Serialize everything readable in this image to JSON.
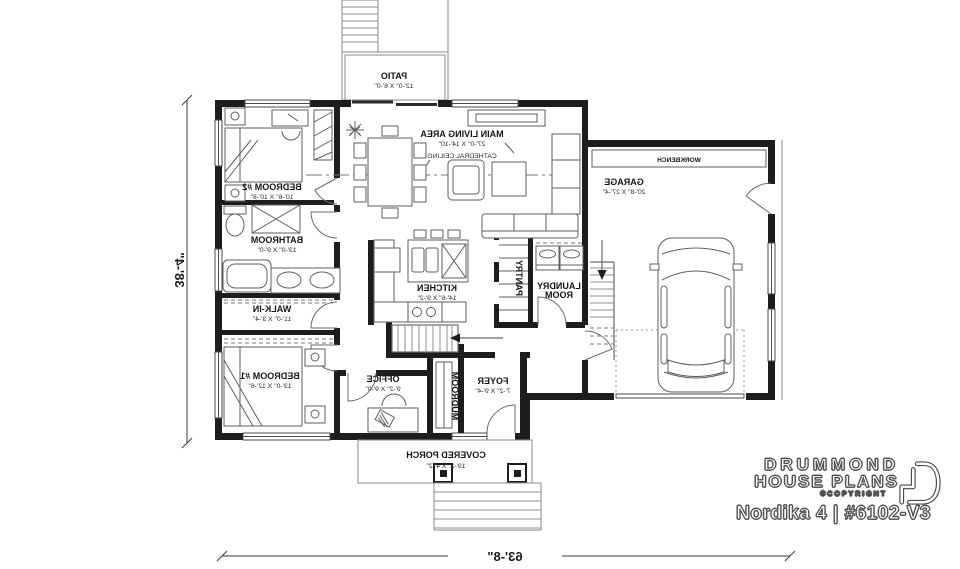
{
  "plan": {
    "rooms": {
      "patio": {
        "name": "PATIO",
        "size": "12'-0\" X 6'-0\""
      },
      "living": {
        "name": "MAIN LIVING AREA",
        "size": "27'-0\" X 14'-10\"",
        "note": "CATHEDRAL CEILING"
      },
      "bedroom2": {
        "name": "BEDROOM #2",
        "size": "10'-6\" X 10'-8\""
      },
      "bathroom": {
        "name": "BATHROOM",
        "size": "13'-0\" X 9'-0\""
      },
      "walkin": {
        "name": "WALK-IN",
        "size": "11'-0\" X 3'-4\""
      },
      "bedroom1": {
        "name": "BEDROOM #1",
        "size": "13'-0\" X 12'-6\""
      },
      "kitchen": {
        "name": "KITCHEN",
        "size": "14'-6\" X 9'-2\""
      },
      "pantry": {
        "name": "PANTRY"
      },
      "laundry": {
        "line1": "LAUNDRY",
        "line2": "ROOM"
      },
      "office": {
        "name": "OFFICE",
        "size": "9'-2\" X 9'-0\""
      },
      "mudroom": {
        "name": "MUDROOM"
      },
      "foyer": {
        "name": "FOYER",
        "size": "7'-2\" X 9'-4\""
      },
      "porch": {
        "name": "COVERED PORCH",
        "size": "19'-2\" X 4'-2\""
      },
      "garage": {
        "name": "GARAGE",
        "size": "20'-8\" X 27'-4\""
      },
      "workbench": {
        "name": "WORKBENCH"
      }
    },
    "dimensions": {
      "width": "63'-8\"",
      "height": "38'-4\""
    }
  },
  "branding": {
    "brand_line1": "DRUMMOND",
    "brand_line2": "HOUSE PLANS",
    "copyright": "©COPYRIGHT",
    "plan_title": "Nordika 4 | #6102-V3"
  },
  "colors": {
    "wall": "#1d1d1d",
    "line": "#5f5f5f",
    "text": "#161616"
  }
}
